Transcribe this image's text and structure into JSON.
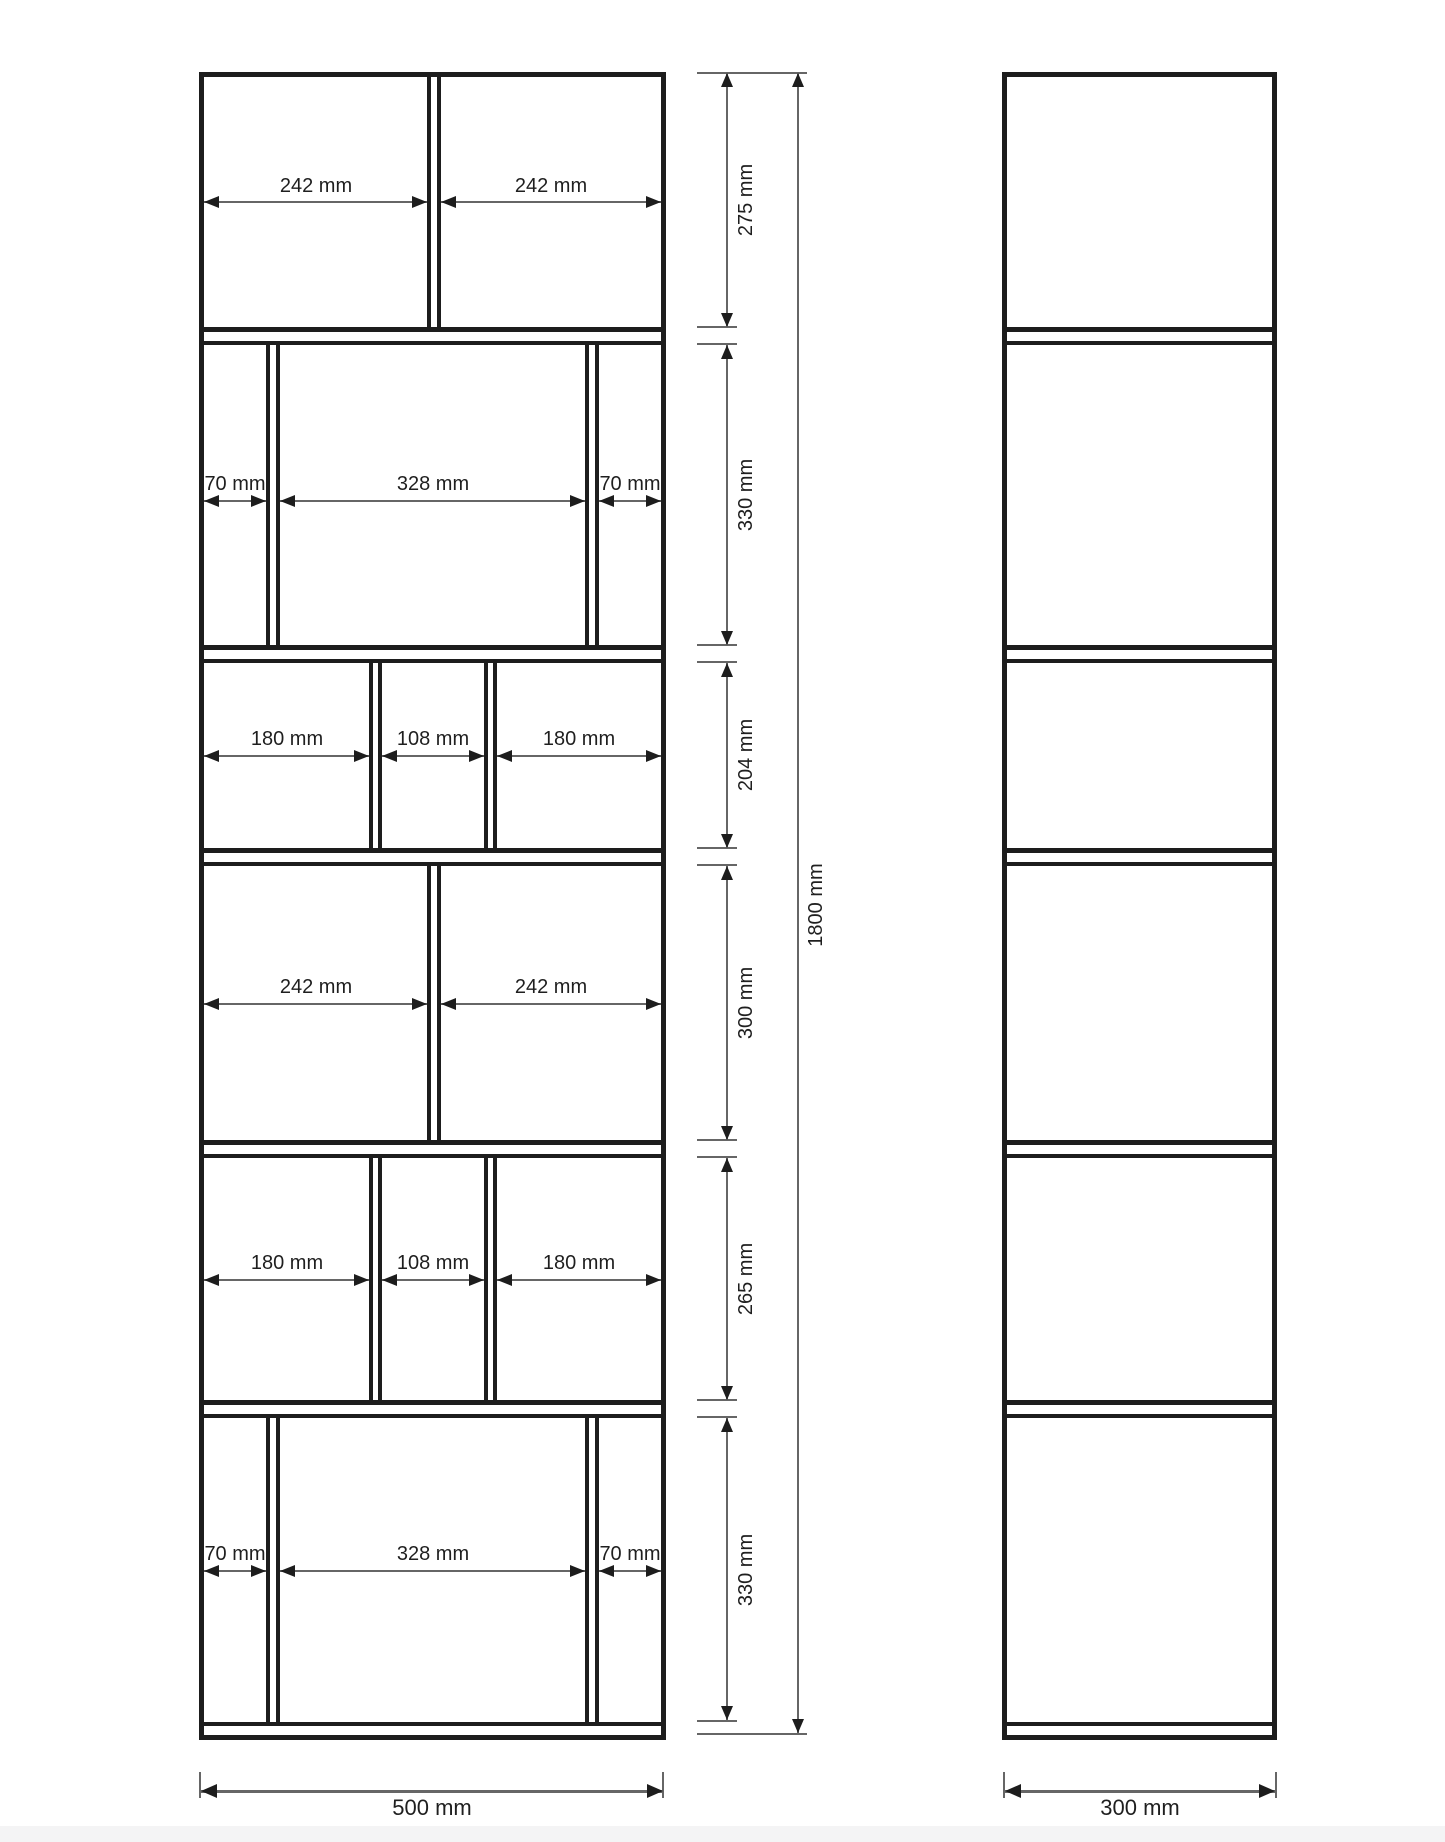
{
  "front_view": {
    "sections": [
      {
        "height_label": "275 mm",
        "compartments": [
          "242 mm",
          "242 mm"
        ]
      },
      {
        "height_label": "330 mm",
        "compartments": [
          "70 mm",
          "328 mm",
          "70 mm"
        ]
      },
      {
        "height_label": "204 mm",
        "compartments": [
          "180 mm",
          "108 mm",
          "180 mm"
        ]
      },
      {
        "height_label": "300 mm",
        "compartments": [
          "242 mm",
          "242 mm"
        ]
      },
      {
        "height_label": "265 mm",
        "compartments": [
          "180 mm",
          "108 mm",
          "180 mm"
        ]
      },
      {
        "height_label": "330 mm",
        "compartments": [
          "70 mm",
          "328 mm",
          "70 mm"
        ]
      }
    ],
    "total_height_label": "1800 mm",
    "total_width_label": "500 mm"
  },
  "side_view": {
    "width_label": "300 mm"
  },
  "colors": {
    "structure_line": "#1d1d1d",
    "dimension_line": "#666666",
    "text": "#1f1f1f",
    "footer_bar": "#f4f4f5"
  }
}
